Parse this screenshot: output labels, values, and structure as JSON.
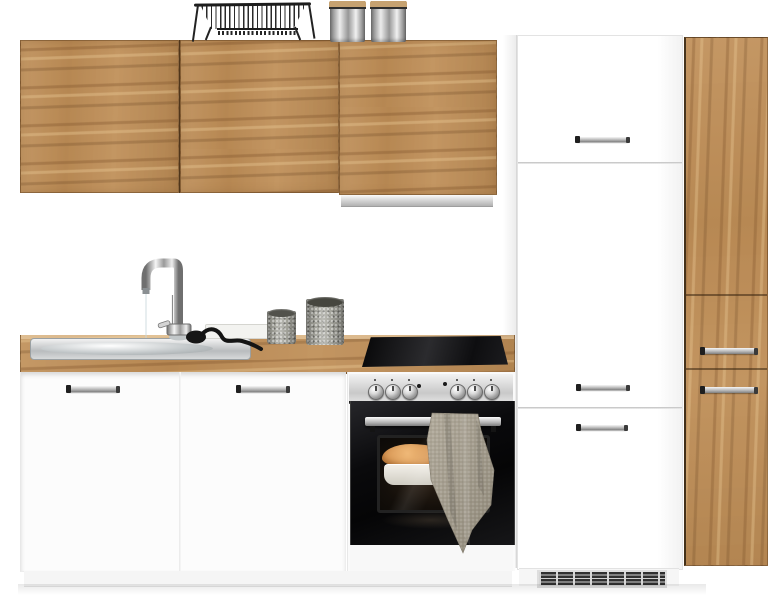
{
  "image": {
    "kind": "product-photo",
    "subject": "kitchen cabinet set with oven, sink and tall fridge housing"
  },
  "colors": {
    "wood_base": "#bf8f58",
    "wood_streak": "#7a4e27",
    "wood_hi": "#e8c896",
    "wood_seam": "#4f351a",
    "counter_base": "#cda267",
    "white_cab": "#fcfcfc",
    "seam_grey": "#c9c9c9",
    "hood_strip": "#cdcdcd",
    "steel_panel": "#d6d6d6",
    "oven_black": "#0b0b0d",
    "chrome_hi": "#f6f6f6",
    "chrome_mid": "#b9b9b9",
    "chrome_dark": "#808080",
    "handle_cap": "#1f1f1f",
    "towel": "#a59e8f",
    "canister": "#a2a29a",
    "canister_top": "#52524c",
    "metal_can_hi": "#ececec",
    "metal_can_dk": "#737373",
    "lid_tan": "#c6a271",
    "vent_dark": "#2f2f2f",
    "grille_frame": "#dedede",
    "food_orange": "#dfa263",
    "dish_white": "#efece4"
  },
  "inventory": {
    "wall_cabinet_doors": 3,
    "base_cabinet_doors": 2,
    "fridge_housing_handles": 3,
    "pullout_cabinet_handles": 2,
    "oven_knobs": 6,
    "counter_canisters": 2,
    "top_canisters": 2,
    "objects": [
      "wall-cabinets",
      "extractor-hood-strip",
      "dish-rack",
      "storage-canisters",
      "fridge-housing-cabinet",
      "ventilation-grille",
      "pullout-tall-cabinet",
      "countertop",
      "sink",
      "faucet",
      "spray-hose",
      "cutting-board",
      "cooktop",
      "base-cabinets",
      "oven",
      "baking-dish",
      "kitchen-towel"
    ]
  }
}
